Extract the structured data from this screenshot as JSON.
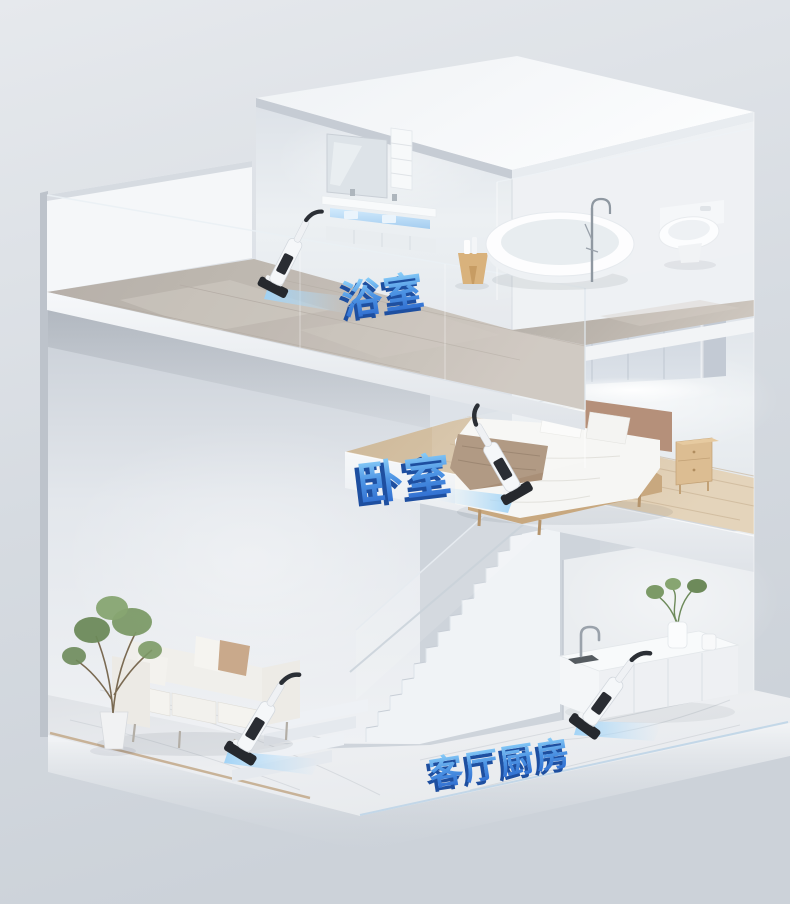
{
  "scene": {
    "type": "3d-cutaway-home-render",
    "description": "Isometric cutaway dollhouse of a duplex home with a cordless wet-dry vacuum cleaner shown in every room",
    "background_top": "#e5e8ec",
    "background_bottom": "#ccd2d9",
    "beam_blue": "#a9d8f7"
  },
  "labels": {
    "bathroom": "浴室",
    "bedroom": "卧室",
    "living_kitchen": "客厅厨房"
  },
  "label_style": {
    "fill_top": "#8ed2fa",
    "fill_bottom": "#2a66cc",
    "extrude": "#1e4fa0"
  },
  "rooms": {
    "bathroom": {
      "objects": [
        "mirror",
        "wall-shelf",
        "floating-vanity",
        "blue-lit-towel-shelf",
        "wooden-stool",
        "toiletry-bottles",
        "freestanding-bathtub",
        "floor-standing-faucet",
        "wall-hung-toilet",
        "glass-balustrade",
        "cordless-wet-dry-vacuum",
        "blue-light-beam"
      ]
    },
    "bedroom": {
      "objects": [
        "wall-cabinet",
        "led-under-light",
        "double-bed",
        "pillows",
        "throw-blanket",
        "wooden-nightstand",
        "glass-balustrade",
        "cordless-wet-dry-vacuum",
        "blue-light-beam"
      ]
    },
    "living_room": {
      "objects": [
        "three-seat-sofa",
        "back-cushions",
        "tan-pillow",
        "potted-plant",
        "cordless-wet-dry-vacuum",
        "blue-light-beam"
      ]
    },
    "kitchen": {
      "objects": [
        "island-counter",
        "gooseneck-faucet",
        "sink",
        "vase-with-plant",
        "cabinet-doors",
        "cordless-wet-dry-vacuum",
        "blue-light-beam"
      ]
    },
    "stairs": {
      "objects": [
        "straight-flight",
        "corner-steps",
        "glass-balustrade",
        "handrail"
      ]
    }
  },
  "vacuums": {
    "count": 4,
    "body_color": "#f5f7f9",
    "trim_color": "#26292e",
    "beam_color": "#a9d8f7",
    "locations": [
      "bathroom",
      "bedroom",
      "living-room",
      "kitchen"
    ]
  }
}
